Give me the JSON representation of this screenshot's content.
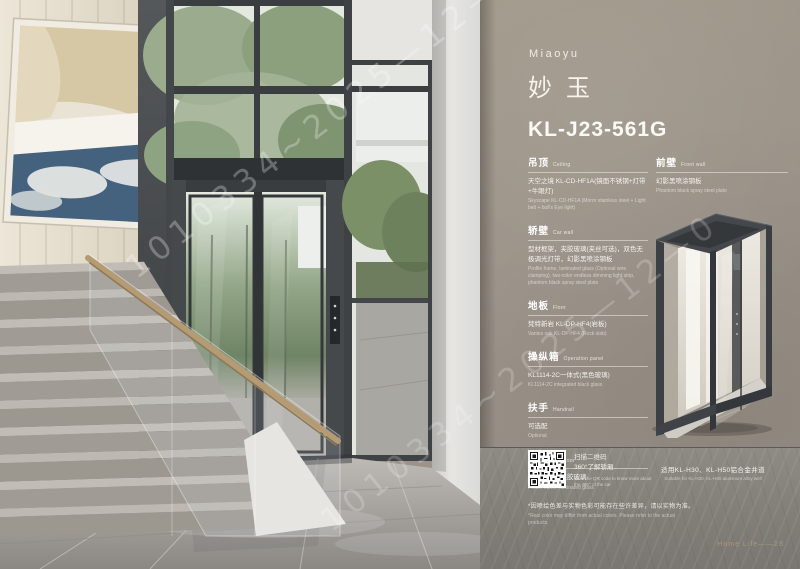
{
  "panel": {
    "brand_en": "Miaoyu",
    "brand_cn": "妙玉",
    "model": "KL-J23-561G",
    "sections_left": [
      {
        "title_cn": "吊顶",
        "title_en": "Ceiling",
        "body_cn": "天空之境 KL-CD-HF1A(镜面不锈钢+灯带+牛眼灯)",
        "body_en": "Skyscape KL-CD-HF1A (Mirror stainless steel + Light belt + bull's Eye light)"
      },
      {
        "title_cn": "轿壁",
        "title_en": "Car wall",
        "body_cn": "型材框架，夹胶玻璃(夹丝可选)，双色无极调光灯带，幻影黑喷涂钢板",
        "body_en": "Profile frame, laminated glass (Optional wire clamping), two-color endless dimming light strip, phantom black spray steel plate"
      },
      {
        "title_cn": "地板",
        "title_en": "Floor",
        "body_cn": "梵特新岩 KL-DP-HF4(岩板)",
        "body_en": "Vantes oak KL-DP-HF4 (Rock slab)"
      },
      {
        "title_cn": "操纵箱",
        "title_en": "Operation panel",
        "body_cn": "KL1114-2C一体式(黑色玻璃)",
        "body_en": "KL1114-2C integrated black glass"
      },
      {
        "title_cn": "扶手",
        "title_en": "Handrail",
        "body_cn": "可选配",
        "body_en": "Optional"
      },
      {
        "title_cn": "轿门",
        "title_en": "Car door",
        "body_cn": "型材框架，夹胶玻璃",
        "body_en": "Profile frame, laminated glass"
      }
    ],
    "sections_right": [
      {
        "title_cn": "前壁",
        "title_en": "Front wall",
        "body_cn": "幻影黑喷涂钢板",
        "body_en": "Phantom black spray steel plate"
      }
    ],
    "qr": {
      "cn1": "扫描二维码",
      "cn2": "360°了解轿厢",
      "en1": "Scan the QR code to know more about",
      "en2": "the 360° of the car"
    },
    "suitable_cn": "适用KL-H30、KL-H50铝合金井道",
    "suitable_en": "Suitable for KL-H30, KL-H50 aluminum alloy well",
    "disclaimer_cn": "*因喷绘色差与实物色彩可能存在些许差异，请以实物为准。",
    "disclaimer_en": "*Real color may differ from actual colors. Please refer to the actual products.",
    "page_footer": "Home Life——28"
  },
  "watermark": {
    "text": "1010334~2025—12—0"
  },
  "colors": {
    "panel_bg": "#9a9289",
    "footer_gold": "#ab9770",
    "frame_dark": "#3a3d40"
  }
}
